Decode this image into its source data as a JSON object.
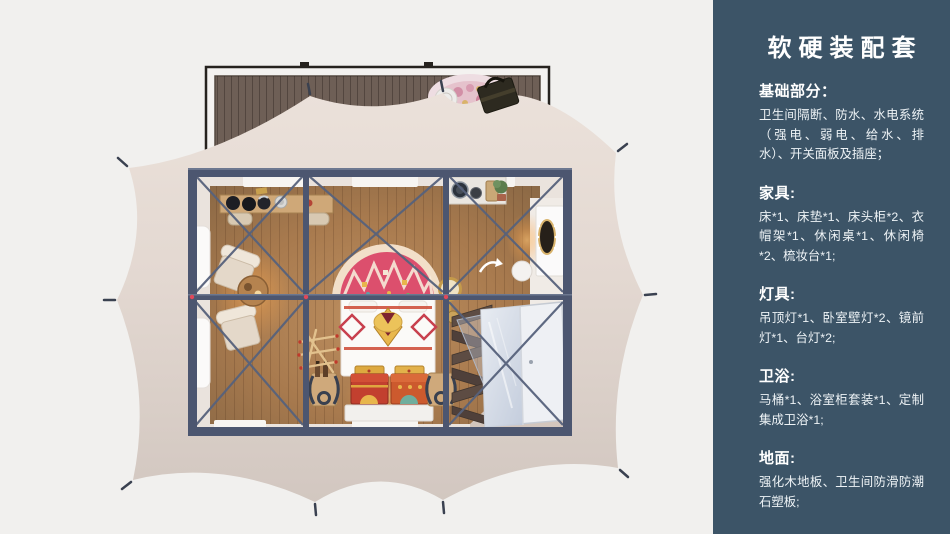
{
  "page": {
    "background": "#f1f0ee"
  },
  "sidebar": {
    "background": "#3c5467",
    "text_color": "#ffffff",
    "title": "软硬装配套",
    "sections": [
      {
        "heading": "基础部分：",
        "body": "卫生间隔断、防水、水电系统（强电、弱电、给水、排水）、开关面板及插座；"
      },
      {
        "heading": "家具:",
        "body": "床*1、床垫*1、床头柜*2、衣帽架*1、休闲桌*1、休闲椅*2、梳妆台*1;"
      },
      {
        "heading": "灯具:",
        "body": "吊顶灯*1、卧室壁灯*2、镜前灯*1、台灯*2;"
      },
      {
        "heading": "卫浴:",
        "body": "马桶*1、浴室柜套装*1、定制集成卫浴*1;"
      },
      {
        "heading": "地面:",
        "body": "强化木地板、卫生间防滑防潮石塑板;"
      }
    ]
  },
  "illustration": {
    "description": "Top-down 3D render of a safari glamping tent: front wood deck with rug and tote bag, beige scalloped tent canvas staked at the tips, steel-framed room with wood floor, bed with arched tapestry rug and painted chests, lounge chairs with tea table, console table, wash counter, dressing table with lighted mirror, coat rack, zigzag shelf and integrated bathroom pod",
    "parts": [
      "wood-deck",
      "deck-rug",
      "tote-bag",
      "tent-canvas",
      "stakes",
      "steel-frame",
      "cross-bracing",
      "wood-floor",
      "bed",
      "arch-tapestry-rug",
      "painted-chests",
      "foot-benches",
      "coat-rack",
      "lounge-chairs",
      "tea-table",
      "console-table",
      "wash-counter",
      "plant",
      "dressing-table",
      "mirror-with-lights",
      "stool",
      "floor-mirror",
      "zigzag-shelf",
      "bathroom-pod",
      "entry-platform"
    ],
    "colors": {
      "tent_canvas": "#e7ddd6",
      "deck_wood": "#6e5f56",
      "frame_steel": "#4c5670",
      "floor_wood": "#a87a4e",
      "accent_pink": "#dc4f6d",
      "accent_red": "#c2402f",
      "accent_gold": "#e9b84d",
      "bathroom_white": "#eef0f4"
    }
  }
}
